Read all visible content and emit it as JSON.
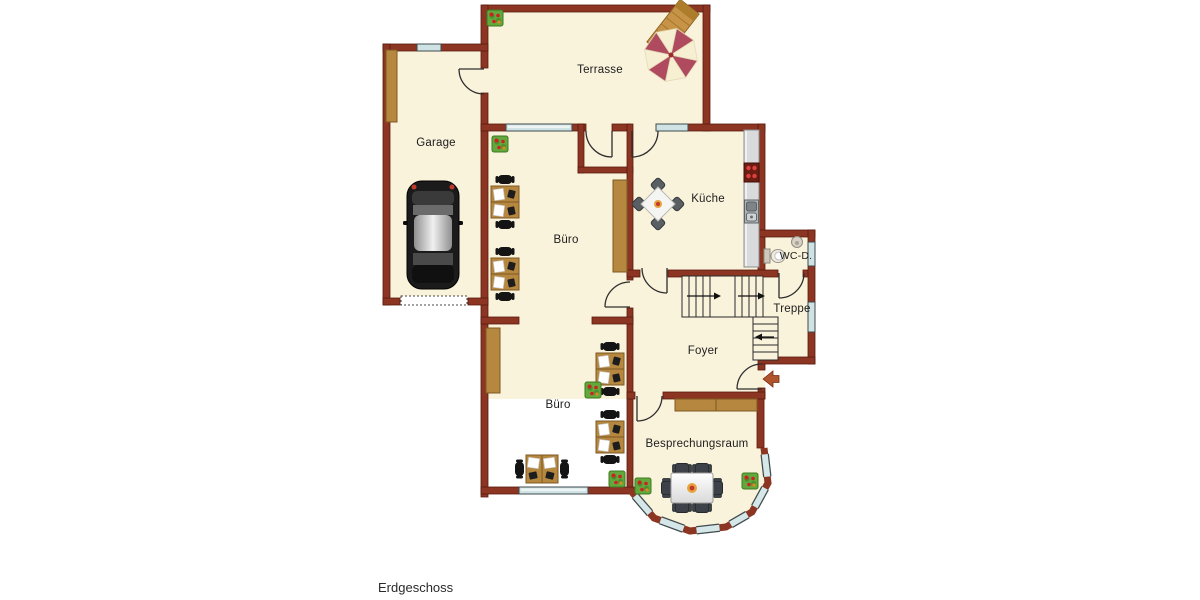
{
  "title": "Erdgeschoss",
  "rooms": {
    "terrasse": "Terrasse",
    "garage": "Garage",
    "buero_top": "Büro",
    "kueche": "Küche",
    "wc": "WC-D.",
    "treppe": "Treppe",
    "foyer": "Foyer",
    "buero_bottom": "Büro",
    "besprechungsraum": "Besprechungsraum"
  },
  "colors": {
    "wall": "#8c3523",
    "floor": "#faf3dc",
    "window_glass": "#cfe3e5",
    "wood": "#b5873f",
    "outside": "#ffffff",
    "umbrella_red": "#b04a5e",
    "umbrella_cream": "#f6efd2",
    "entrance_arrow": "#b0542e"
  },
  "icons": {
    "car": "car-icon",
    "umbrella": "sun-umbrella-icon",
    "lounger": "lounger-icon",
    "plant": "plant-icon",
    "desk": "desk-group-icon",
    "stairs": "stairs-icon",
    "toilet": "toilet-icon",
    "washbasin": "washbasin-icon",
    "stove": "stove-icon",
    "sink": "sink-icon",
    "entrance_arrow": "entrance-arrow-icon"
  }
}
